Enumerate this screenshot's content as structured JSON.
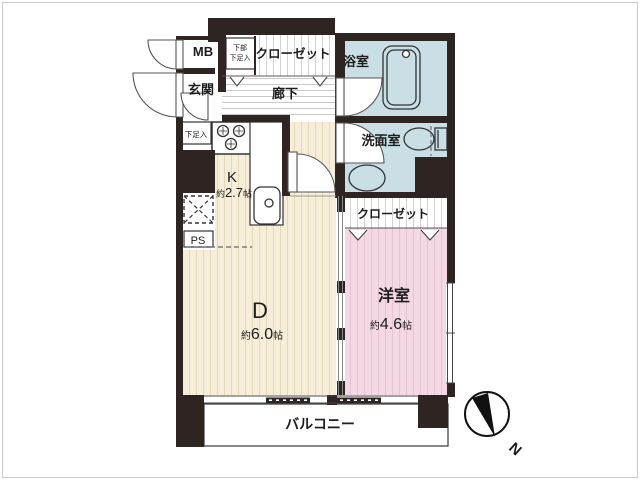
{
  "plan": {
    "rooms": {
      "mb": {
        "label": "MB"
      },
      "genkan": {
        "label": "玄関"
      },
      "hall": {
        "label": "廊下"
      },
      "closet_hallثupper": {
        "label": ""
      },
      "closet_hall": {
        "label": "クローゼット"
      },
      "shoe_upper": {
        "line1": "下部",
        "line2": "下足入"
      },
      "shoe": {
        "label": "下足入"
      },
      "bath": {
        "label": "浴室"
      },
      "wash": {
        "label": "洗面室"
      },
      "kitchen": {
        "label": "K",
        "prefix": "約",
        "value": "2.7",
        "unit": "帖"
      },
      "ps": {
        "label": "PS"
      },
      "dining": {
        "label": "D",
        "prefix": "約",
        "value": "6.0",
        "unit": "帖"
      },
      "bedroom": {
        "label": "洋室",
        "prefix": "約",
        "value": "4.6",
        "unit": "帖"
      },
      "closet_bed": {
        "label": "クローゼット"
      },
      "balcony": {
        "label": "バルコニー"
      }
    },
    "compass": {
      "label": "N"
    },
    "colors": {
      "wall": "#2e2522",
      "bath_blue": "#c9dfe5",
      "kitchen_cream": "#f6eed8",
      "bedroom_pink": "#f4d8e3",
      "line": "#3a3a3a"
    }
  }
}
